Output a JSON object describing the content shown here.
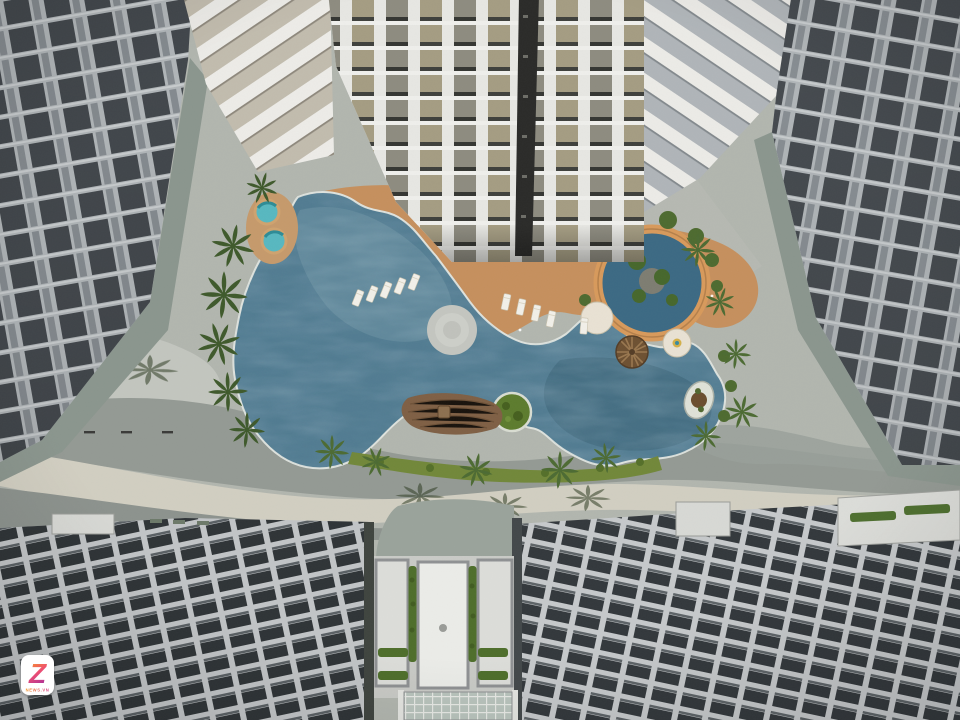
{
  "scene": {
    "kind": "aerial-courtyard-photo",
    "palette": {
      "pool_water": "#527c92",
      "pool_water_light": "#6f95a6",
      "pool_water_dark": "#3a6176",
      "deck_orange": "#c6905e",
      "paving_base": "#b2b6af",
      "paving_dark_wave": "#949a94",
      "paving_cream_wave": "#d2cfc2",
      "facade_mullion": "#b7bcbe",
      "facade_window": "#3b4145",
      "tower_white": "#e7e7e3",
      "balcony_tan": "#a59d83",
      "hedge_green": "#4e6e2b",
      "palm_green": "#3f5a2c",
      "spa_turquoise": "#58b8c0",
      "parasol_brown": "#6e5132"
    }
  },
  "watermark": {
    "logo_letter": "Z",
    "logo_caption": "NEWS.VN",
    "gradient_top": "#f7a11c",
    "gradient_bottom": "#a62d9c"
  }
}
